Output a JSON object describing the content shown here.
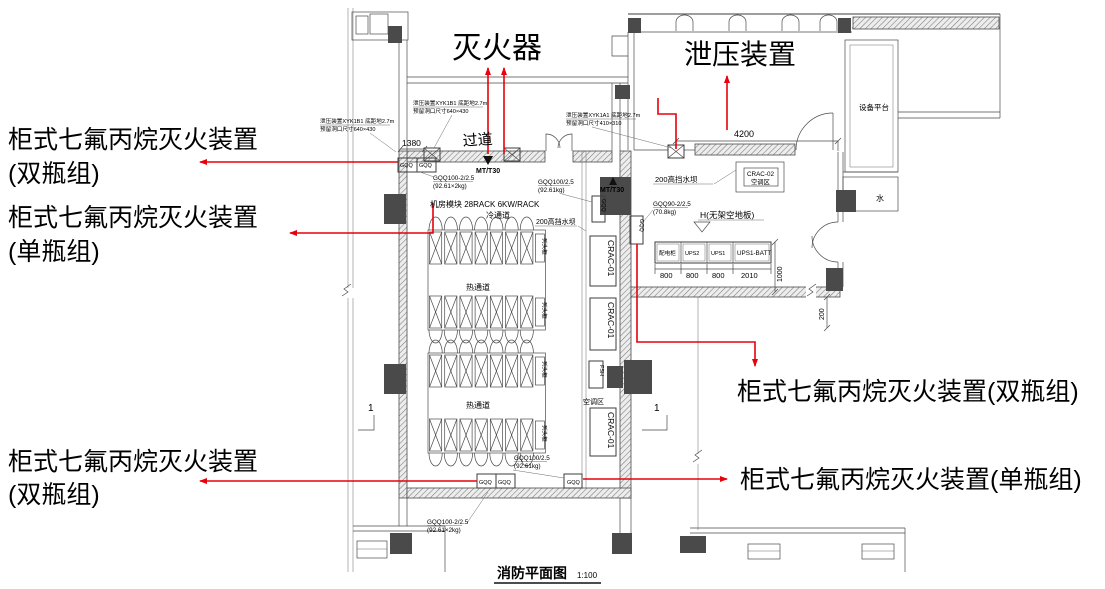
{
  "title": {
    "text": "消防平面图",
    "scale": "1:100"
  },
  "red_labels": {
    "extinguisher": "灭火器",
    "pressure_relief": "泄压装置",
    "l1a": "柜式七氟丙烷灭火装置",
    "l1b": "(双瓶组)",
    "l2a": "柜式七氟丙烷灭火装置",
    "l2b": "(单瓶组)",
    "l3a": "柜式七氟丙烷灭火装置",
    "l3b": "(双瓶组)",
    "r1": "柜式七氟丙烷灭火装置(双瓶组)",
    "r2": "柜式七氟丙烷灭火装置(单瓶组)"
  },
  "rooms": {
    "corridor": "过道",
    "equipment_platform": "设备平台",
    "water": "水",
    "ac_zone": "空调区",
    "hot_aisle_a": "热通道",
    "hot_aisle_b": "热通道"
  },
  "annotations": {
    "module_line1": "机房模块 28RACK 6KW/RACK",
    "module_line2": "冷通道",
    "xyk1_l1": "泄压装置XYK1B1 底距地2.7m",
    "xyk1_l2": "预留洞口尺寸640×430",
    "xyk2_l1": "泄压装置XYK1B1 底距地2.7m",
    "xyk2_l2": "预留洞口尺寸640×430",
    "xyk3_l1": "泄压装置XYK1A1 底距地2.7m",
    "xyk3_l2": "预留洞口尺寸410×310",
    "water_dam_1": "200高挡水坝",
    "water_dam_2": "200高挡水坝",
    "no_raised_floor": "H(无架空地板)",
    "gqq_tl_l1": "GQQ100-2/2.5",
    "gqq_tl_l2": "(92.61×2kg)",
    "gqq_tm_l1": "GQQ100/2.5",
    "gqq_tm_l2": "(92.61kg)",
    "gqq_r_l1": "GQQ90-2/2.5",
    "gqq_r_l2": "(70.8kg)",
    "gqq_bm_l1": "GQQ100/2.5",
    "gqq_bm_l2": "(92.61kg)",
    "gqq_bl_l1": "GQQ100-2/2.5",
    "gqq_bl_l2": "(92.61×2kg)"
  },
  "equipment": {
    "gqq": "GQQ",
    "mt30": "MT/T30",
    "crac01": "CRAC-01",
    "crac02_l1": "CRAC-02",
    "crac02_l2": "空调区",
    "fsh": "FSH",
    "row_head": "列头柜",
    "ups_cell_1": "配电柜",
    "ups_cell_2": "UPS2",
    "ups_cell_3": "UPS1",
    "ups_cell_4": "UPS1-BATT"
  },
  "dimensions": {
    "corridor_w": "1380",
    "relief_room": "4200",
    "ups1": "800",
    "ups2": "800",
    "ups3": "800",
    "ups4": "2010",
    "ups_depth": "1000",
    "wall_gap": "200"
  },
  "section": {
    "marker": "1"
  },
  "plan": {
    "rack_groups": [
      {
        "x": 428,
        "y_top": 214
      },
      {
        "x": 428,
        "y_top": 337
      }
    ],
    "racks_per_row": 7,
    "rows_per_group": 2
  },
  "colors": {
    "red": "#e8000a",
    "line": "#3d3d3d",
    "dark": "#4a4a4a"
  }
}
